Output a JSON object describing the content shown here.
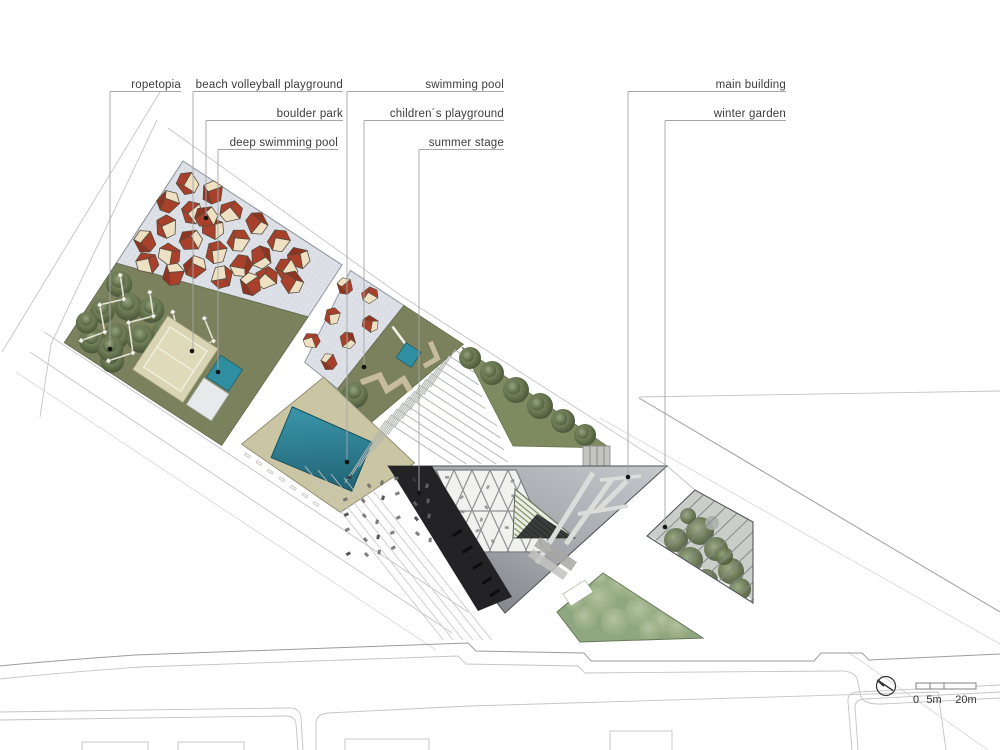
{
  "annotations": {
    "items": [
      {
        "label": "ropetopia"
      },
      {
        "label": "beach volleyball playground"
      },
      {
        "label": "boulder park"
      },
      {
        "label": "deep swimming pool"
      },
      {
        "label": "swimming pool"
      },
      {
        "label": "children´s playground"
      },
      {
        "label": "summer stage"
      },
      {
        "label": "main building"
      },
      {
        "label": "winter garden"
      }
    ]
  },
  "scale_bar": {
    "labels": [
      "0",
      "5m",
      "20m"
    ]
  },
  "compass": {
    "type": "north-arrow"
  },
  "palette": {
    "olive": "#7b815c",
    "olive_dark": "#6c7350",
    "gray_field": "#dde1e7",
    "boulder_red": "#a8402b",
    "boulder_red_dark": "#8f3421",
    "boulder_cream": "#eee0c3",
    "sand_court": "#d9d5b4",
    "teal_pool": "#2f8fa1",
    "pool_deep": "#1c5b6d",
    "deck_khaki": "#cac5a2",
    "building_light": "#c6c8cd",
    "building_dark": "#77797e",
    "stage_black": "#232325",
    "lawn_green": "#7e8a5f",
    "garden_green": "#8ea77f",
    "line_gray": "#9c9c9c"
  },
  "features": {
    "boulders_large": [
      [
        16,
        16,
        10,
        0
      ],
      [
        42,
        10,
        50,
        1
      ],
      [
        68,
        16,
        120,
        0
      ],
      [
        96,
        12,
        200,
        1
      ],
      [
        124,
        14,
        80,
        0
      ],
      [
        150,
        18,
        150,
        1
      ],
      [
        10,
        42,
        90,
        1
      ],
      [
        36,
        38,
        30,
        0
      ],
      [
        62,
        40,
        160,
        1
      ],
      [
        90,
        36,
        75,
        0
      ],
      [
        118,
        38,
        220,
        1
      ],
      [
        146,
        34,
        15,
        0
      ],
      [
        22,
        64,
        45,
        0
      ],
      [
        50,
        34,
        130,
        1
      ],
      [
        50,
        62,
        130,
        1
      ],
      [
        78,
        58,
        60,
        0
      ],
      [
        106,
        56,
        260,
        1
      ],
      [
        134,
        52,
        110,
        0
      ],
      [
        158,
        42,
        190,
        1
      ],
      [
        12,
        88,
        20,
        1
      ],
      [
        40,
        86,
        170,
        0
      ],
      [
        68,
        82,
        95,
        1
      ],
      [
        96,
        76,
        240,
        0
      ],
      [
        124,
        66,
        35,
        1
      ],
      [
        26,
        105,
        145,
        0
      ],
      [
        54,
        100,
        65,
        1
      ]
    ],
    "boulders_small": [
      [
        204,
        16,
        30,
        1
      ],
      [
        230,
        10,
        100,
        0
      ],
      [
        246,
        34,
        170,
        1
      ],
      [
        210,
        48,
        60,
        0
      ],
      [
        236,
        60,
        210,
        1
      ],
      [
        206,
        80,
        140,
        0
      ],
      [
        232,
        88,
        20,
        1
      ]
    ],
    "ropetopia_trees": [
      [
        14,
        138,
        13
      ],
      [
        34,
        152,
        14
      ],
      [
        15,
        170,
        12
      ],
      [
        40,
        183,
        13
      ],
      [
        22,
        200,
        13
      ],
      [
        55,
        142,
        13
      ],
      [
        62,
        172,
        14
      ],
      [
        50,
        206,
        12
      ],
      [
        78,
        154,
        12
      ],
      [
        42,
        197,
        13
      ],
      [
        8,
        188,
        11
      ]
    ],
    "rope_paths": [
      [
        [
          10,
          130
        ],
        [
          26,
          148
        ],
        [
          9,
          166
        ],
        [
          28,
          186
        ],
        [
          13,
          206
        ]
      ],
      [
        [
          44,
          128
        ],
        [
          60,
          146
        ],
        [
          43,
          165
        ],
        [
          63,
          188
        ],
        [
          47,
          208
        ]
      ],
      [
        [
          74,
          132
        ],
        [
          92,
          148
        ],
        [
          78,
          168
        ],
        [
          98,
          186
        ]
      ],
      [
        [
          104,
          120
        ],
        [
          124,
          134
        ],
        [
          112,
          152
        ]
      ]
    ],
    "playground_tree": [
      272,
      102,
      13
    ],
    "lawn_trees": [
      [
        470,
        358,
        11
      ],
      [
        492,
        373,
        12
      ],
      [
        516,
        390,
        13
      ],
      [
        540,
        406,
        13
      ],
      [
        563,
        421,
        12
      ],
      [
        585,
        435,
        11
      ]
    ],
    "garden_bushes": [
      [
        600,
        600,
        16
      ],
      [
        620,
        585,
        13
      ],
      [
        640,
        612,
        15
      ],
      [
        660,
        600,
        14
      ],
      [
        663,
        622,
        12
      ],
      [
        615,
        622,
        14
      ],
      [
        585,
        618,
        12
      ],
      [
        635,
        590,
        11
      ],
      [
        650,
        630,
        11
      ],
      [
        600,
        578,
        10
      ],
      [
        678,
        627,
        12
      ],
      [
        575,
        603,
        9
      ]
    ],
    "wintergarden_bushes": [
      [
        676,
        540,
        12
      ],
      [
        700,
        531,
        14
      ],
      [
        690,
        560,
        13
      ],
      [
        716,
        549,
        12
      ],
      [
        731,
        571,
        13
      ],
      [
        706,
        581,
        12
      ],
      [
        740,
        589,
        11
      ],
      [
        724,
        556,
        9
      ],
      [
        688,
        516,
        8
      ],
      [
        712,
        523,
        7
      ]
    ]
  }
}
